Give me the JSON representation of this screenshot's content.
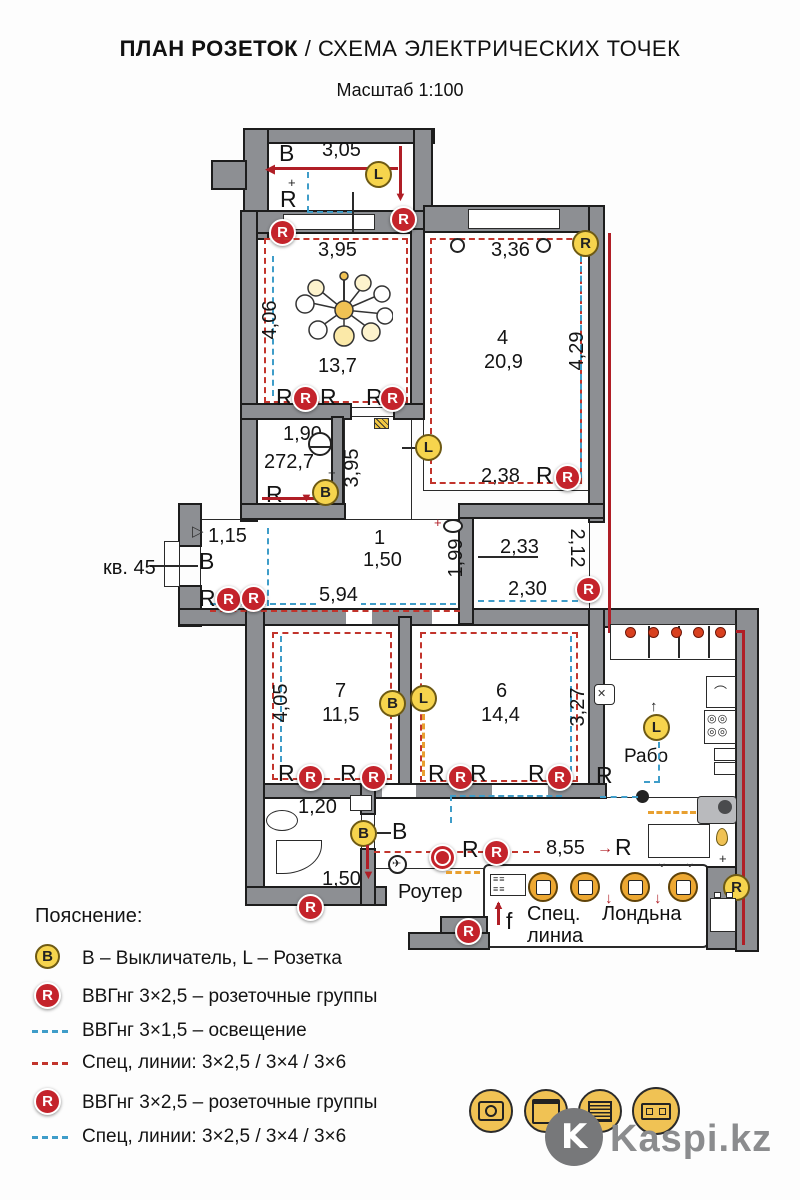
{
  "title": {
    "main": "ПЛАН РОЗЕТОК",
    "rest": "/ СХЕМА ЭЛЕКТРИЧЕСКИХ ТОЧЕК",
    "scale": "Масштаб 1:100"
  },
  "plan": {
    "apartment": "кв. 45",
    "letters": {
      "r": "R",
      "b": "B",
      "l": "L",
      "v": "В",
      "f": "f"
    },
    "dims": {
      "balcony_w": "3,05",
      "living_w": "3,95",
      "living_h": "4,06",
      "room4_w": "3,36",
      "room4_h": "4,29",
      "room4_bottom": "2,38",
      "room2_w": "1,90",
      "room2_label": "272,7",
      "mid_v": "3,95",
      "entry_w": "1,15",
      "hall_w": "5,94",
      "hall_right": "1,99",
      "wc_top": "2,33",
      "wc_side": "2,12",
      "wc_bottom": "2,30",
      "room7_h": "4,05",
      "room6_h": "3,27",
      "bath_w": "1,20",
      "bath_s": "1,50",
      "corridor_w": "8,55"
    },
    "rooms": {
      "living_area": "13,7",
      "room4_num": "4",
      "room4_area": "20,9",
      "hall_num": "1",
      "hall_area": "1,50",
      "room7_num": "7",
      "room7_area": "11,5",
      "room6_num": "6",
      "room6_area": "14,4"
    },
    "texts": {
      "router": "Роутер",
      "work": "Рабо",
      "spec_line_1": "Спец.",
      "spec_line_2": "линиа",
      "laundry": "Лондьна"
    }
  },
  "legend": {
    "heading": "Пояснение:",
    "rows": [
      {
        "type": "badge-b",
        "text": "В – Выкличатель, L – Розетка"
      },
      {
        "type": "badge-r",
        "text": "ВВГнг 3×2,5 – розеточные группы"
      },
      {
        "type": "dash-blue",
        "text": "ВВГнг 3×1,5 – освещение"
      },
      {
        "type": "dash-red",
        "text": "Спец, линии:  3×2,5 / 3×4 / 3×6"
      },
      {
        "type": "badge-r",
        "text": "ВВГнг 3×2,5 – розеточные группы"
      },
      {
        "type": "dash-blue",
        "text": "Спец, линии:  3×2,5 / 3×4 / 3×6"
      }
    ]
  },
  "footer": {
    "brand": "Kaspi.kz"
  }
}
